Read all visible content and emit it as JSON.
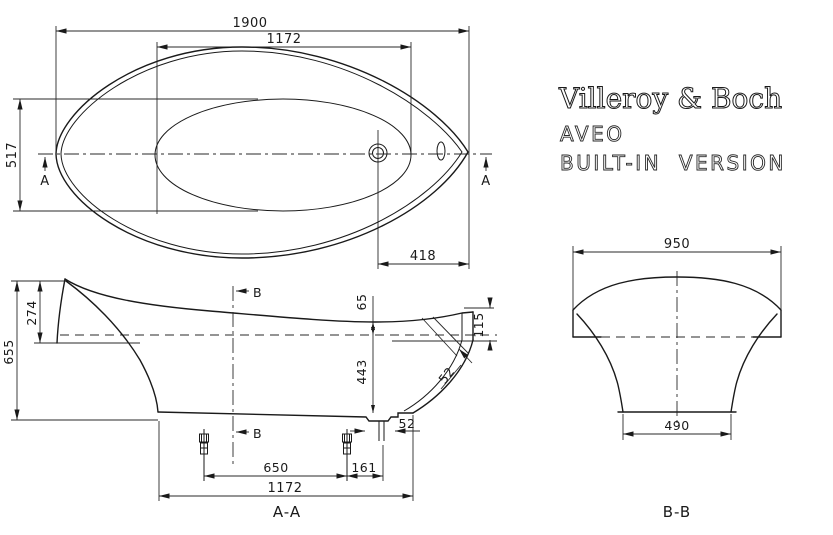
{
  "colors": {
    "ink": "#1a1a1a",
    "background": "#ffffff"
  },
  "drawing": {
    "brand": {
      "logo": "Villeroy & Boch",
      "product": "AVEO",
      "variant": "BUILT-IN  VERSION"
    },
    "plan": {
      "overall_length": "1900",
      "basin_length": "1172",
      "basin_width": "517",
      "drain_offset": "418",
      "cut_label": "A"
    },
    "section_aa": {
      "label": "A-A",
      "overall_height": "655",
      "back_rim_height": "274",
      "rim_to_waterline": "65",
      "rim_to_floor": "443",
      "front_rim_height": "115",
      "wall_thickness": "52",
      "sump_width": "52",
      "feet_spacing": "650",
      "foot_to_outlet": "161",
      "base_length": "1172",
      "cut_label": "B"
    },
    "section_bb": {
      "label": "B-B",
      "overall_width": "950",
      "base_width": "490"
    }
  }
}
